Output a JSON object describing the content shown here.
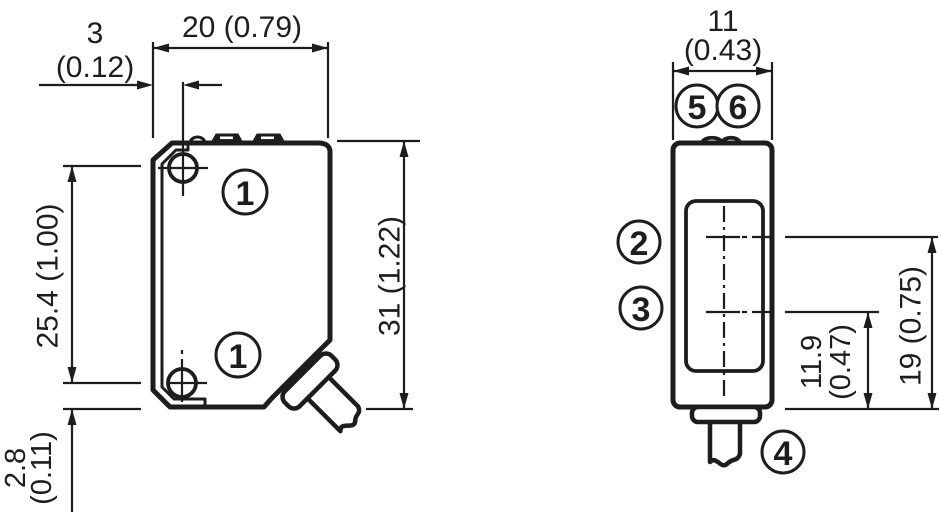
{
  "drawing": {
    "left_view": {
      "dims": {
        "body_width": "20 (0.79)",
        "hole_offset_value": "3",
        "hole_offset_inch": "(0.12)",
        "hole_spacing": "25.4 (1.00)",
        "body_height": "31 (1.22)",
        "hole_to_bottom_value": "2.8",
        "hole_to_bottom_inch": "(0.11)"
      },
      "callouts": {
        "mounting_hole": "1"
      }
    },
    "right_view": {
      "dims": {
        "body_depth_value": "11",
        "body_depth_inch": "(0.43)",
        "receiver_axis_value": "11.9",
        "receiver_axis_inch": "(0.47)",
        "sender_axis": "19 (0.75)"
      },
      "callouts": {
        "sender_axis": "2",
        "receiver_axis": "3",
        "cable": "4",
        "indicator_left": "5",
        "indicator_right": "6"
      }
    }
  }
}
